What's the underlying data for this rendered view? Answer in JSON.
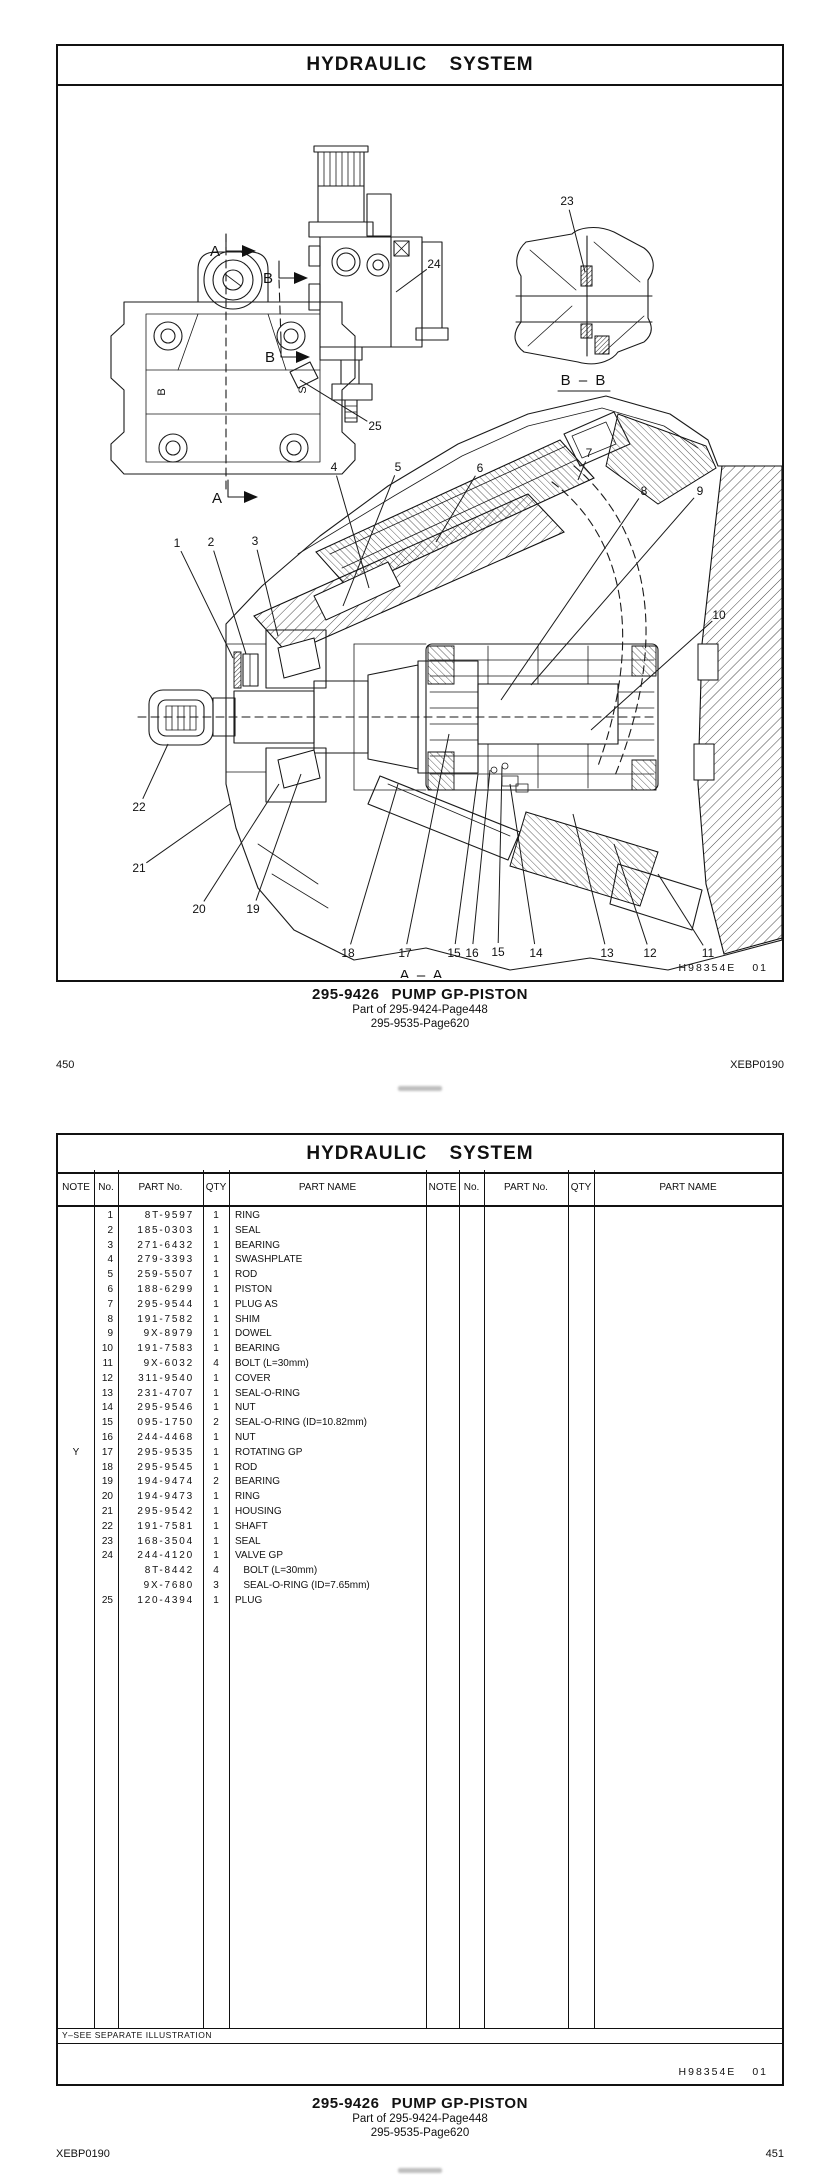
{
  "doc": {
    "title": "HYDRAULIC  SYSTEM",
    "drawing_code": "H98354E",
    "drawing_revision": "01",
    "doc_code": "XEBP0190",
    "caption": {
      "part_number": "295-9426",
      "part_name": "PUMP GP-PISTON",
      "parent_ref": "Part of 295-9424-Page448",
      "alt_ref": "295-9535-Page620"
    }
  },
  "page1": {
    "page_number": "450",
    "section_label_a": "A",
    "section_label_b": "B",
    "section_view_aa": "A – A",
    "section_view_bb": "B – B",
    "port_label_b": "B",
    "port_label_s": "S",
    "callouts": [
      {
        "n": "1",
        "x": 119,
        "y": 459,
        "tx": 175,
        "ty": 574
      },
      {
        "n": "2",
        "x": 153,
        "y": 458,
        "tx": 188,
        "ty": 570
      },
      {
        "n": "3",
        "x": 197,
        "y": 457,
        "tx": 220,
        "ty": 552
      },
      {
        "n": "4",
        "x": 276,
        "y": 383,
        "tx": 311,
        "ty": 504
      },
      {
        "n": "5",
        "x": 340,
        "y": 383,
        "tx": 285,
        "ty": 522
      },
      {
        "n": "6",
        "x": 422,
        "y": 384,
        "tx": 378,
        "ty": 458
      },
      {
        "n": "7",
        "x": 531,
        "y": 369,
        "tx": 520,
        "ty": 396
      },
      {
        "n": "8",
        "x": 586,
        "y": 407,
        "tx": 443,
        "ty": 616
      },
      {
        "n": "9",
        "x": 642,
        "y": 407,
        "tx": 473,
        "ty": 601
      },
      {
        "n": "10",
        "x": 661,
        "y": 531,
        "tx": 533,
        "ty": 646
      },
      {
        "n": "11",
        "x": 650,
        "y": 869,
        "tx": 600,
        "ty": 790
      },
      {
        "n": "12",
        "x": 592,
        "y": 869,
        "tx": 556,
        "ty": 760
      },
      {
        "n": "13",
        "x": 549,
        "y": 869,
        "tx": 515,
        "ty": 730
      },
      {
        "n": "14",
        "x": 478,
        "y": 869,
        "tx": 452,
        "ty": 700
      },
      {
        "n": "15",
        "x": 396,
        "y": 869,
        "tx": 420,
        "ty": 690
      },
      {
        "n": "16",
        "x": 414,
        "y": 869,
        "tx": 432,
        "ty": 686
      },
      {
        "n": "15",
        "x": 440,
        "y": 868,
        "tx": 444,
        "ty": 682
      },
      {
        "n": "17",
        "x": 347,
        "y": 869,
        "tx": 391,
        "ty": 650
      },
      {
        "n": "18",
        "x": 290,
        "y": 869,
        "tx": 340,
        "ty": 700
      },
      {
        "n": "19",
        "x": 195,
        "y": 825,
        "tx": 243,
        "ty": 690
      },
      {
        "n": "20",
        "x": 141,
        "y": 825,
        "tx": 221,
        "ty": 700
      },
      {
        "n": "21",
        "x": 81,
        "y": 784,
        "tx": 172,
        "ty": 720
      },
      {
        "n": "22",
        "x": 81,
        "y": 723,
        "tx": 110,
        "ty": 660
      },
      {
        "n": "23",
        "x": 509,
        "y": 117,
        "tx": 527,
        "ty": 188
      },
      {
        "n": "24",
        "x": 376,
        "y": 180,
        "tx": 338,
        "ty": 208
      },
      {
        "n": "25",
        "x": 317,
        "y": 342,
        "tx": 242,
        "ty": 296
      }
    ]
  },
  "page2": {
    "page_number": "451",
    "footnote": "Y–SEE  SEPARATE  ILLUSTRATION",
    "table": {
      "headers": [
        "NOTE",
        "No.",
        "PART No.",
        "QTY",
        "PART NAME"
      ],
      "rows": [
        {
          "note": "",
          "no": "1",
          "part_no": "8T-9597",
          "qty": "1",
          "name": "RING"
        },
        {
          "note": "",
          "no": "2",
          "part_no": "185-0303",
          "qty": "1",
          "name": "SEAL"
        },
        {
          "note": "",
          "no": "3",
          "part_no": "271-6432",
          "qty": "1",
          "name": "BEARING"
        },
        {
          "note": "",
          "no": "4",
          "part_no": "279-3393",
          "qty": "1",
          "name": "SWASHPLATE"
        },
        {
          "note": "",
          "no": "5",
          "part_no": "259-5507",
          "qty": "1",
          "name": "ROD"
        },
        {
          "note": "",
          "no": "6",
          "part_no": "188-6299",
          "qty": "1",
          "name": "PISTON"
        },
        {
          "note": "",
          "no": "7",
          "part_no": "295-9544",
          "qty": "1",
          "name": "PLUG AS"
        },
        {
          "note": "",
          "no": "8",
          "part_no": "191-7582",
          "qty": "1",
          "name": "SHIM"
        },
        {
          "note": "",
          "no": "9",
          "part_no": "9X-8979",
          "qty": "1",
          "name": "DOWEL"
        },
        {
          "note": "",
          "no": "10",
          "part_no": "191-7583",
          "qty": "1",
          "name": "BEARING"
        },
        {
          "note": "",
          "no": "11",
          "part_no": "9X-6032",
          "qty": "4",
          "name": "BOLT (L=30mm)"
        },
        {
          "note": "",
          "no": "12",
          "part_no": "311-9540",
          "qty": "1",
          "name": "COVER"
        },
        {
          "note": "",
          "no": "13",
          "part_no": "231-4707",
          "qty": "1",
          "name": "SEAL-O-RING"
        },
        {
          "note": "",
          "no": "14",
          "part_no": "295-9546",
          "qty": "1",
          "name": "NUT"
        },
        {
          "note": "",
          "no": "15",
          "part_no": "095-1750",
          "qty": "2",
          "name": "SEAL-O-RING (ID=10.82mm)"
        },
        {
          "note": "",
          "no": "16",
          "part_no": "244-4468",
          "qty": "1",
          "name": "NUT"
        },
        {
          "note": "Y",
          "no": "17",
          "part_no": "295-9535",
          "qty": "1",
          "name": "ROTATING GP"
        },
        {
          "note": "",
          "no": "18",
          "part_no": "295-9545",
          "qty": "1",
          "name": "ROD"
        },
        {
          "note": "",
          "no": "19",
          "part_no": "194-9474",
          "qty": "2",
          "name": "BEARING"
        },
        {
          "note": "",
          "no": "20",
          "part_no": "194-9473",
          "qty": "1",
          "name": "RING"
        },
        {
          "note": "",
          "no": "21",
          "part_no": "295-9542",
          "qty": "1",
          "name": "HOUSING"
        },
        {
          "note": "",
          "no": "22",
          "part_no": "191-7581",
          "qty": "1",
          "name": "SHAFT"
        },
        {
          "note": "",
          "no": "23",
          "part_no": "168-3504",
          "qty": "1",
          "name": "SEAL"
        },
        {
          "note": "",
          "no": "24",
          "part_no": "244-4120",
          "qty": "1",
          "name": "VALVE GP"
        },
        {
          "note": "",
          "no": "",
          "part_no": "8T-8442",
          "qty": "4",
          "name": "   BOLT (L=30mm)"
        },
        {
          "note": "",
          "no": "",
          "part_no": "9X-7680",
          "qty": "3",
          "name": "   SEAL-O-RING (ID=7.65mm)"
        },
        {
          "note": "",
          "no": "25",
          "part_no": "120-4394",
          "qty": "1",
          "name": "PLUG"
        }
      ]
    }
  }
}
